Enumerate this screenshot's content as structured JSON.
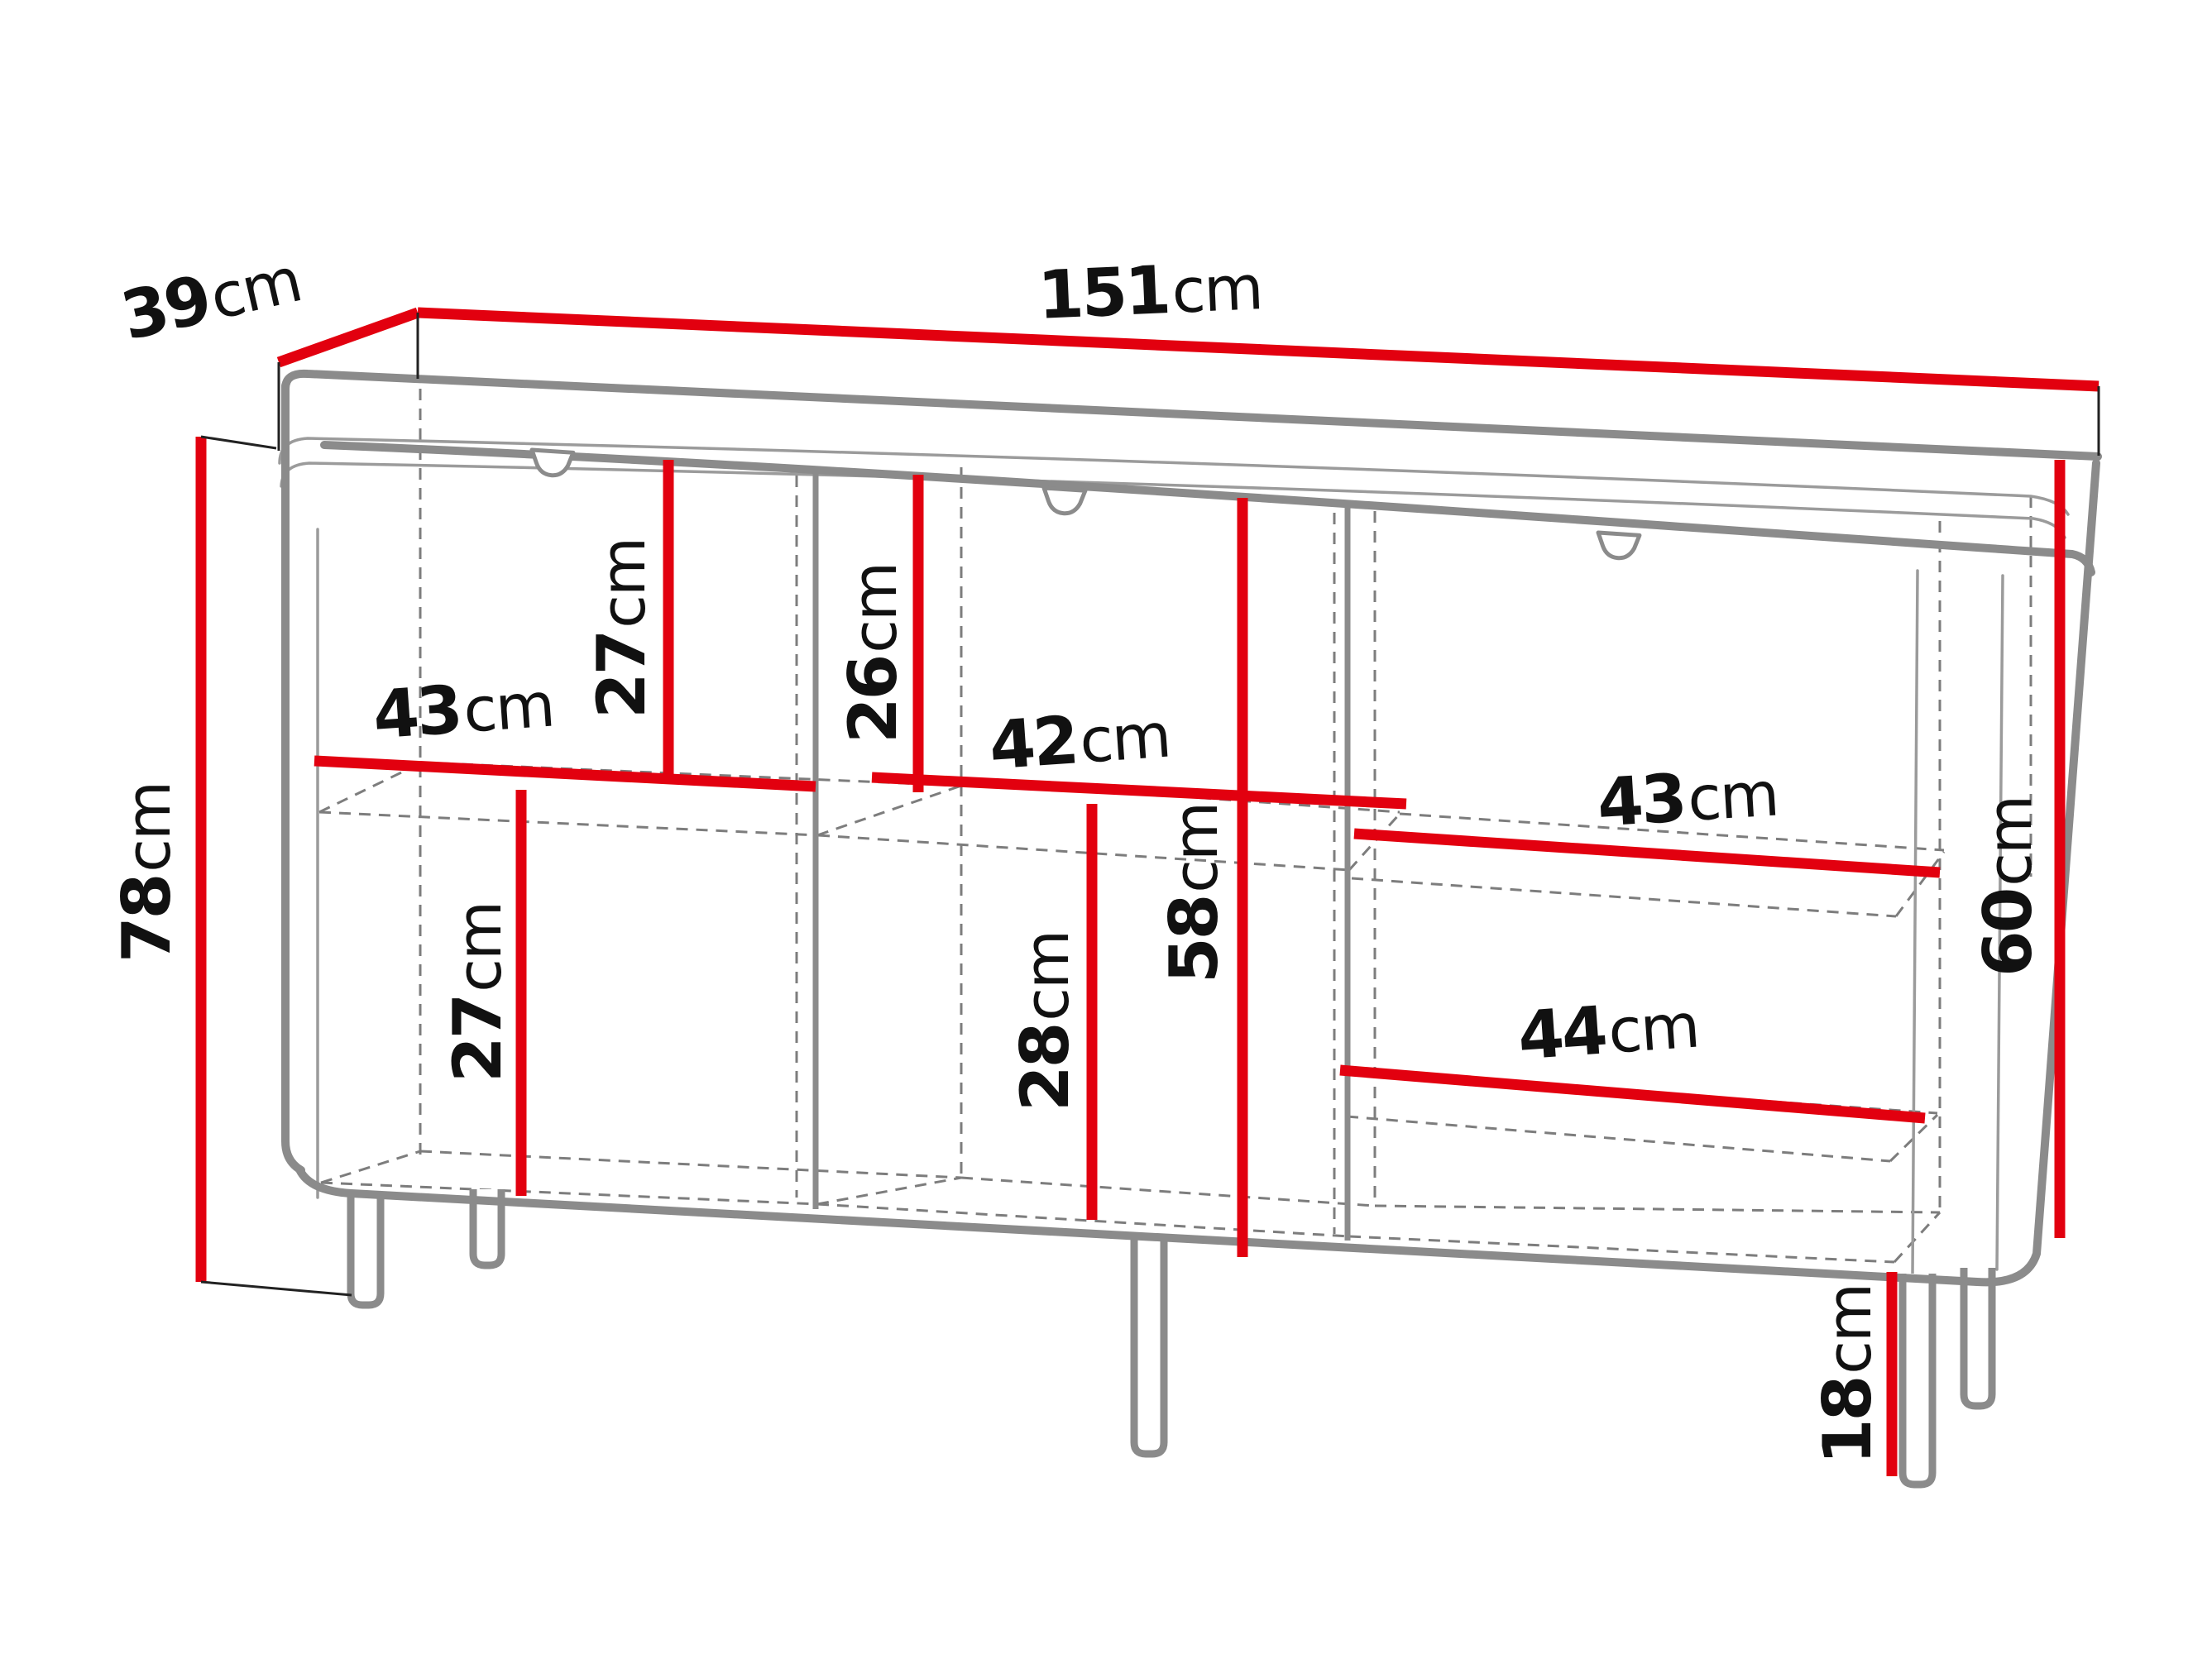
{
  "diagram": {
    "type": "furniture-dimension-diagram",
    "subject": "three-door sideboard wireframe with measurements",
    "background": "#ffffff"
  },
  "colors": {
    "dimension_line": "#e2000f",
    "outline": "#8b8b8b",
    "outline_light": "#9b9b9b",
    "dashed_line": "#7d7d7d",
    "connector_line": "#222222",
    "label_text": "#111111"
  },
  "dimensions": {
    "depth": {
      "value": "39",
      "unit": "cm"
    },
    "width": {
      "value": "151",
      "unit": "cm"
    },
    "height": {
      "value": "78",
      "unit": "cm"
    },
    "left_upper_compartment_height": {
      "value": "27",
      "unit": "cm"
    },
    "left_compartment_width": {
      "value": "43",
      "unit": "cm"
    },
    "middle_upper_compartment_height": {
      "value": "26",
      "unit": "cm"
    },
    "middle_compartment_width": {
      "value": "42",
      "unit": "cm"
    },
    "left_lower_compartment_height": {
      "value": "27",
      "unit": "cm"
    },
    "middle_lower_compartment_height": {
      "value": "28",
      "unit": "cm"
    },
    "middle_interior_height": {
      "value": "58",
      "unit": "cm"
    },
    "right_compartment_width": {
      "value": "43",
      "unit": "cm"
    },
    "right_drawer_width": {
      "value": "44",
      "unit": "cm"
    },
    "right_interior_height": {
      "value": "60",
      "unit": "cm"
    },
    "leg_height": {
      "value": "18",
      "unit": "cm"
    }
  }
}
